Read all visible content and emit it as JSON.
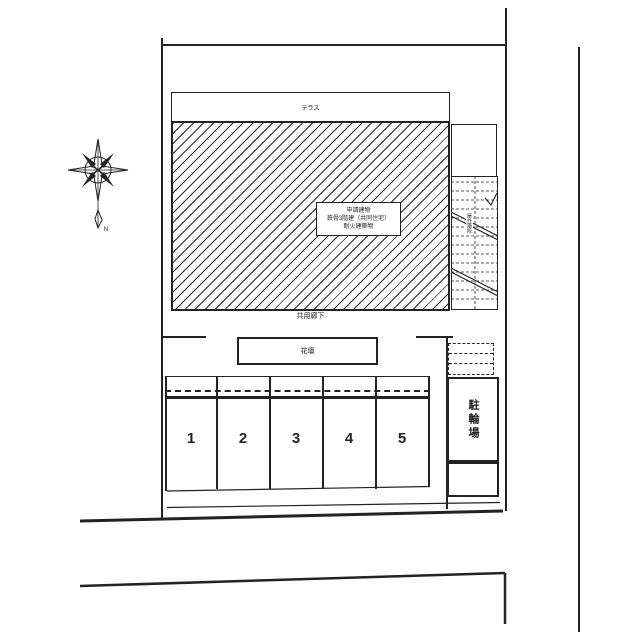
{
  "colors": {
    "line": "#232323",
    "background": "#ffffff"
  },
  "compass": {
    "north_label": "N"
  },
  "terrace": {
    "label": "テラス"
  },
  "building": {
    "label_lines": [
      "申請建物",
      "鉄骨3階建（共同住宅）",
      "耐火建築物"
    ]
  },
  "corridor": {
    "label": "共用廊下"
  },
  "flowerbed": {
    "label": "花壇"
  },
  "stairs": {
    "label": "屋外階段"
  },
  "bicycle_parking": {
    "label": "駐輪場"
  },
  "parking": {
    "stall_numbers": [
      "1",
      "2",
      "3",
      "4",
      "5"
    ]
  }
}
